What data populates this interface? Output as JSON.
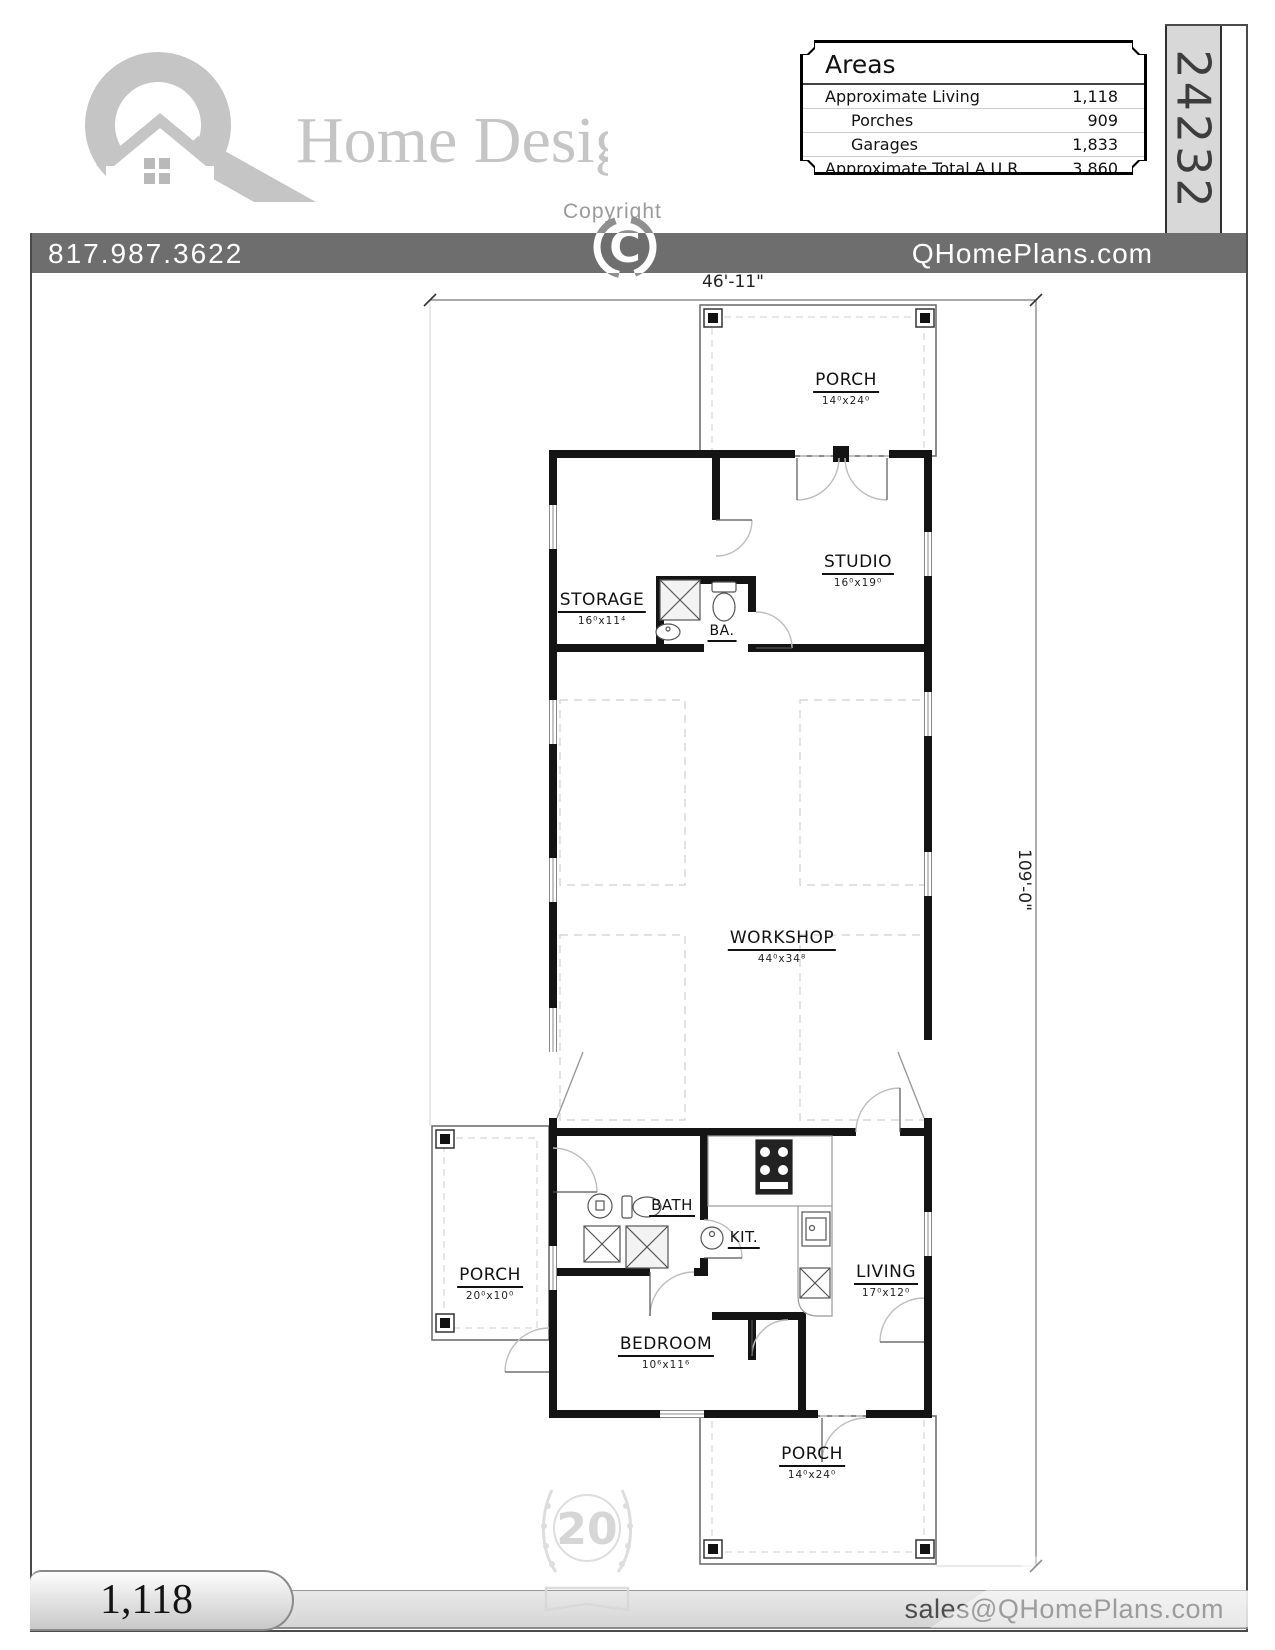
{
  "header": {
    "brand_wordmark": "Home Designs",
    "copyright_label": "Copyright",
    "copyright_symbol": "C",
    "phone": "817.987.3622",
    "website": "QHomePlans.com",
    "plan_number": "24232",
    "areas_table": {
      "title": "Areas",
      "rows": [
        {
          "label": "Approximate Living",
          "value": "1,118"
        },
        {
          "label": "Porches",
          "value": "909"
        },
        {
          "label": "Garages",
          "value": "1,833"
        },
        {
          "label": "Approximate Total A.U.R.",
          "value": "3,860"
        }
      ]
    }
  },
  "plan": {
    "dim_width": "46'-11\"",
    "dim_height": "109'-0\"",
    "rooms": [
      {
        "name": "PORCH",
        "dim": "14⁰x24⁰"
      },
      {
        "name": "STUDIO",
        "dim": "16⁰x19⁰"
      },
      {
        "name": "STORAGE",
        "dim": "16⁰x11⁴"
      },
      {
        "name": "BA.",
        "dim": ""
      },
      {
        "name": "WORKSHOP",
        "dim": "44⁰x34⁸"
      },
      {
        "name": "PORCH",
        "dim": "20⁰x10⁰"
      },
      {
        "name": "BATH",
        "dim": ""
      },
      {
        "name": "KIT.",
        "dim": ""
      },
      {
        "name": "LIVING",
        "dim": "17⁰x12⁰"
      },
      {
        "name": "BEDROOM",
        "dim": "10⁶x11⁶"
      },
      {
        "name": "PORCH",
        "dim": "14⁰x24⁰"
      }
    ]
  },
  "footer": {
    "living_area": "1,118",
    "email": "sales@QHomePlans.com",
    "badge_years": "20"
  }
}
